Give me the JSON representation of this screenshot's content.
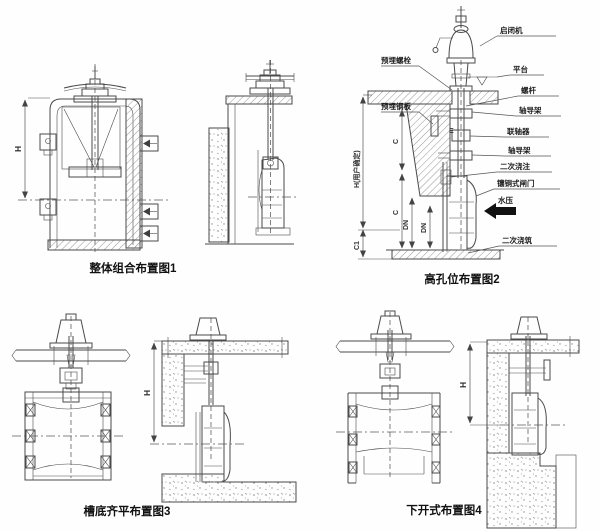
{
  "colors": {
    "ink": "#4a4a4a",
    "caption": "#101010",
    "water_arrow": "#111111"
  },
  "fig1": {
    "caption": "整体组合布置图1",
    "dim_h": "H"
  },
  "fig2": {
    "caption": "高孔位布置图2",
    "right_labels": [
      "启闭机",
      "平台",
      "螺杆",
      "轴导架",
      "联轴器",
      "轴导架",
      "二次浇注",
      "镶铜式闸门",
      "水压",
      "二次浇筑"
    ],
    "left_labels": [
      "预埋螺栓",
      "预埋钢板"
    ],
    "dim_v_main": "H(用户确定)",
    "dim_c1": "C1",
    "dim_c_upper": "C",
    "dim_c_lower": "C",
    "dim_dn_left": "DN",
    "dim_dn_right": "DN",
    "dim_e": "E"
  },
  "fig3": {
    "caption": "槽底齐平布置图3",
    "dim_h": "H"
  },
  "fig4": {
    "caption": "下开式布置图4",
    "dim_h": "H"
  }
}
